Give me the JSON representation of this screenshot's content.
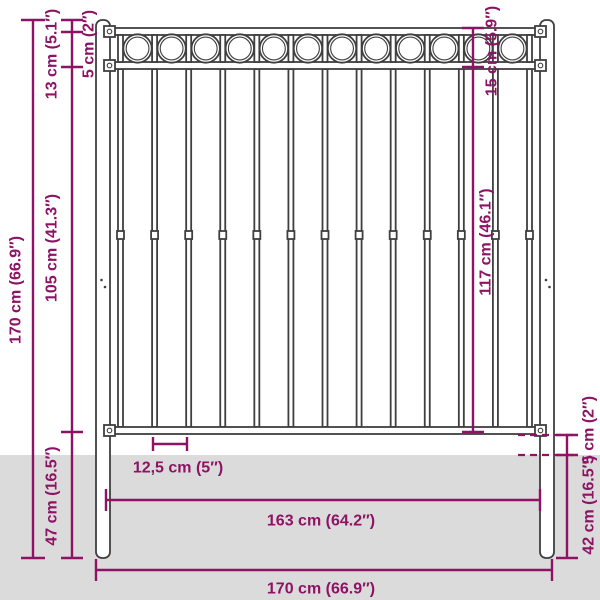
{
  "labels": {
    "total_height_left": "170 cm (66.9″)",
    "top_offset_left": "5 cm (2″)",
    "ring_section_left": "13 cm (5.1″)",
    "panel_height_left": "105 cm (41.3″)",
    "below_rail_left": "47 cm (16.5″)",
    "top_section_right": "15 cm (5.9″)",
    "panel_height_right": "117 cm (46.1″)",
    "rail_to_ground_right": "5 cm (2″)",
    "underground_right": "42 cm (16.5″)",
    "bar_spacing_bottom": "12,5 cm (5″)",
    "panel_width_bottom": "163 cm (64.2″)",
    "total_width_bottom": "170 cm (66.9″)"
  },
  "colors": {
    "dimension": "#8E1365",
    "fence_outline": "#3F3F3F",
    "ground": "#DBDBDB",
    "background": "#FFFFFF"
  },
  "structure": {
    "posts": 2,
    "vertical_bars": 13,
    "rings": 12
  }
}
